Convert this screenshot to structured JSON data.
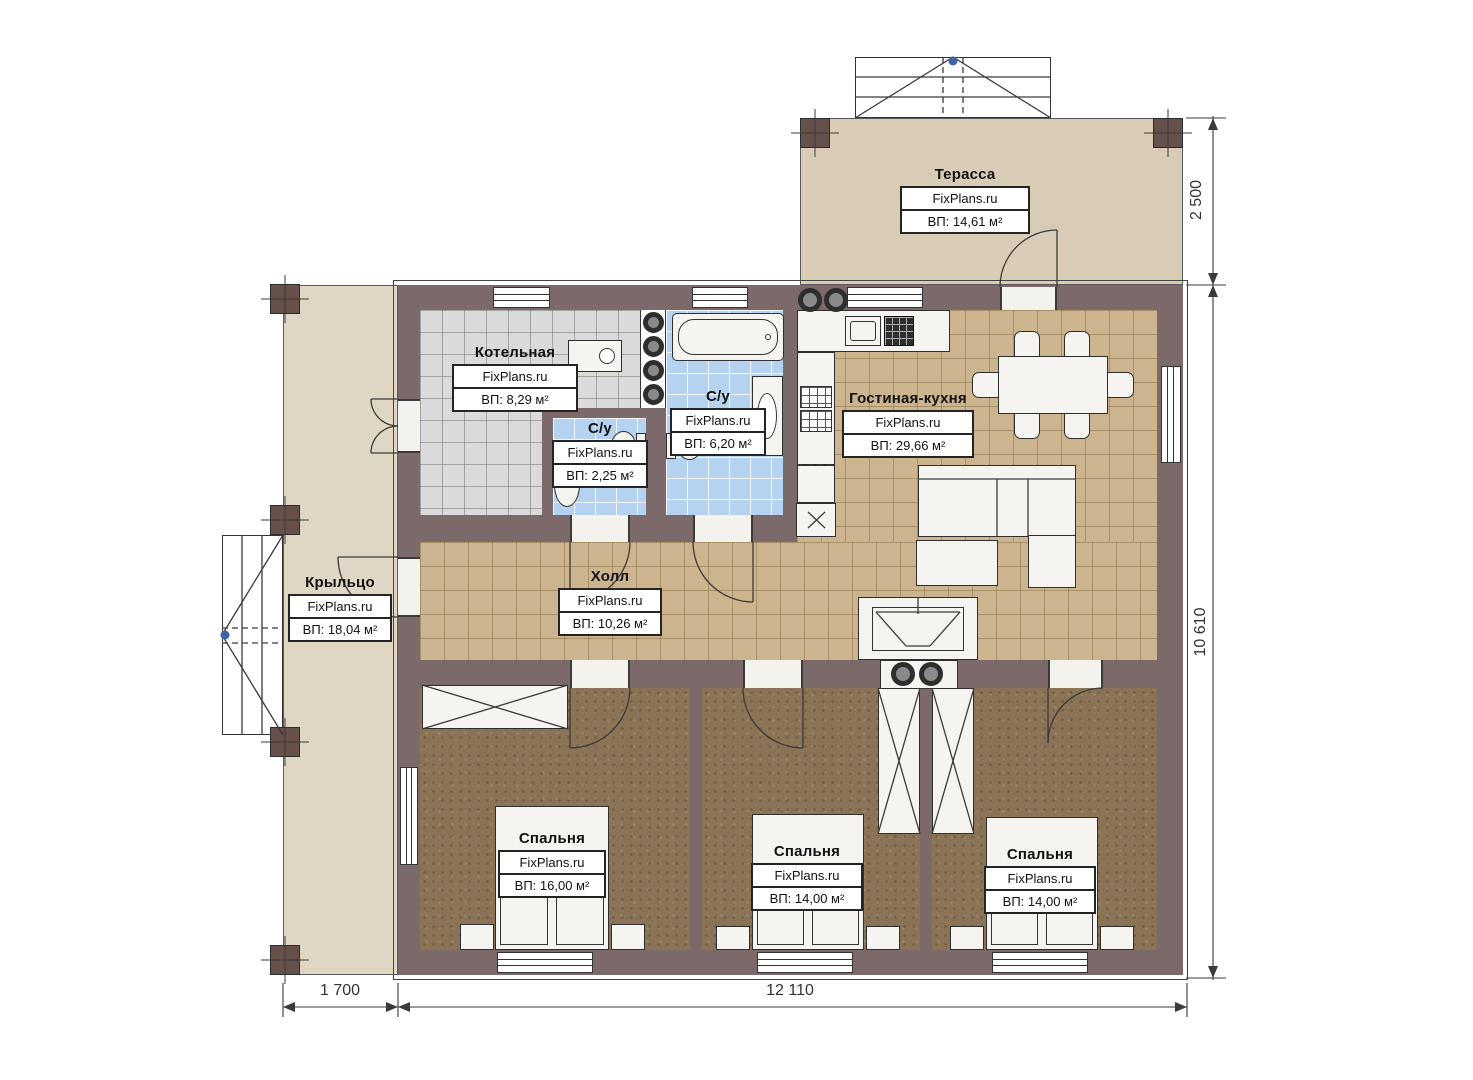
{
  "plan": {
    "watermark": "FixPlans.ru",
    "rooms": [
      {
        "key": "terrace",
        "name": "Терасса",
        "area": "ВП: 14,61 м²"
      },
      {
        "key": "boiler",
        "name": "Котельная",
        "area": "ВП: 8,29 м²"
      },
      {
        "key": "bath-large",
        "name": "С/у",
        "area": "ВП: 6,20 м²"
      },
      {
        "key": "bath-small",
        "name": "С/у",
        "area": "ВП: 2,25 м²"
      },
      {
        "key": "living-kitchen",
        "name": "Гостиная-кухня",
        "area": "ВП: 29,66 м²"
      },
      {
        "key": "hall",
        "name": "Холл",
        "area": "ВП: 10,26 м²"
      },
      {
        "key": "porch",
        "name": "Крыльцо",
        "area": "ВП: 18,04 м²"
      },
      {
        "key": "bedroom-1",
        "name": "Спальня",
        "area": "ВП: 16,00 м²"
      },
      {
        "key": "bedroom-2",
        "name": "Спальня",
        "area": "ВП: 14,00 м²"
      },
      {
        "key": "bedroom-3",
        "name": "Спальня",
        "area": "ВП: 14,00 м²"
      }
    ],
    "dimensions": {
      "terrace_depth": "2 500",
      "house_depth": "10 610",
      "porch_width": "1 700",
      "house_width": "12 110"
    },
    "colors": {
      "wall": "#7c696a",
      "terrace": "#d8ccb6",
      "porch": "#e0d6c4",
      "tile_tan": "#cbb48e",
      "tile_gray": "#dadada",
      "tile_blue": "#b5d3f0",
      "bedroom": "#8b7456",
      "column": "#66504a",
      "furniture": "#f5f4f1",
      "line": "#3a3a3a",
      "accent_blue": "#3b63a6"
    }
  }
}
